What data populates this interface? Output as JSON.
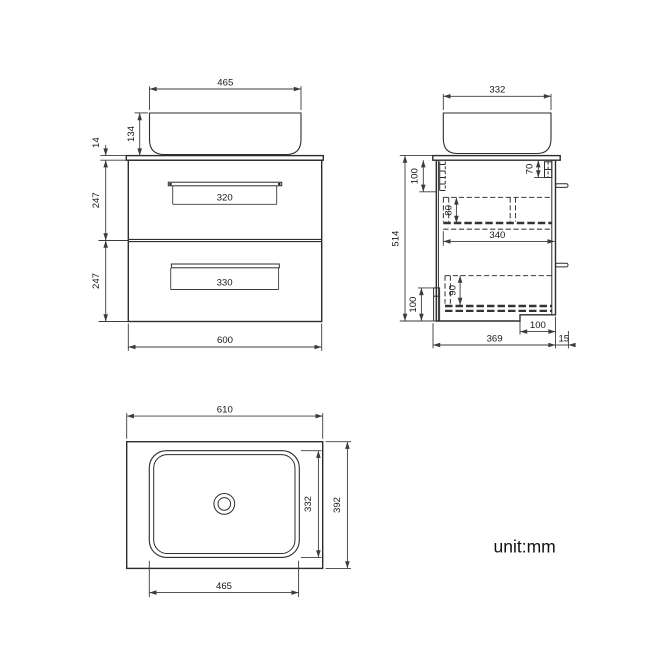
{
  "unit_note": "unit:mm",
  "front_view": {
    "basin_width": "465",
    "basin_height": "134",
    "countertop_thickness": "14",
    "upper_drawer_height": "247",
    "lower_drawer_height": "247",
    "upper_handle_width": "320",
    "lower_handle_width": "330",
    "cabinet_width": "600"
  },
  "side_view": {
    "basin_depth": "332",
    "overall_height": "514",
    "top_bracket_height": "100",
    "right_bracket_height": "70",
    "upper_drawer_inner_height": "80",
    "drawer_inner_depth": "340",
    "lower_drawer_inner_height": "90",
    "bottom_clearance_height": "100",
    "bottom_recess_width": "100",
    "cabinet_depth": "369",
    "back_gap": "15"
  },
  "plan_view": {
    "countertop_width": "610",
    "countertop_depth": "392",
    "basin_width": "465",
    "basin_depth": "332"
  }
}
